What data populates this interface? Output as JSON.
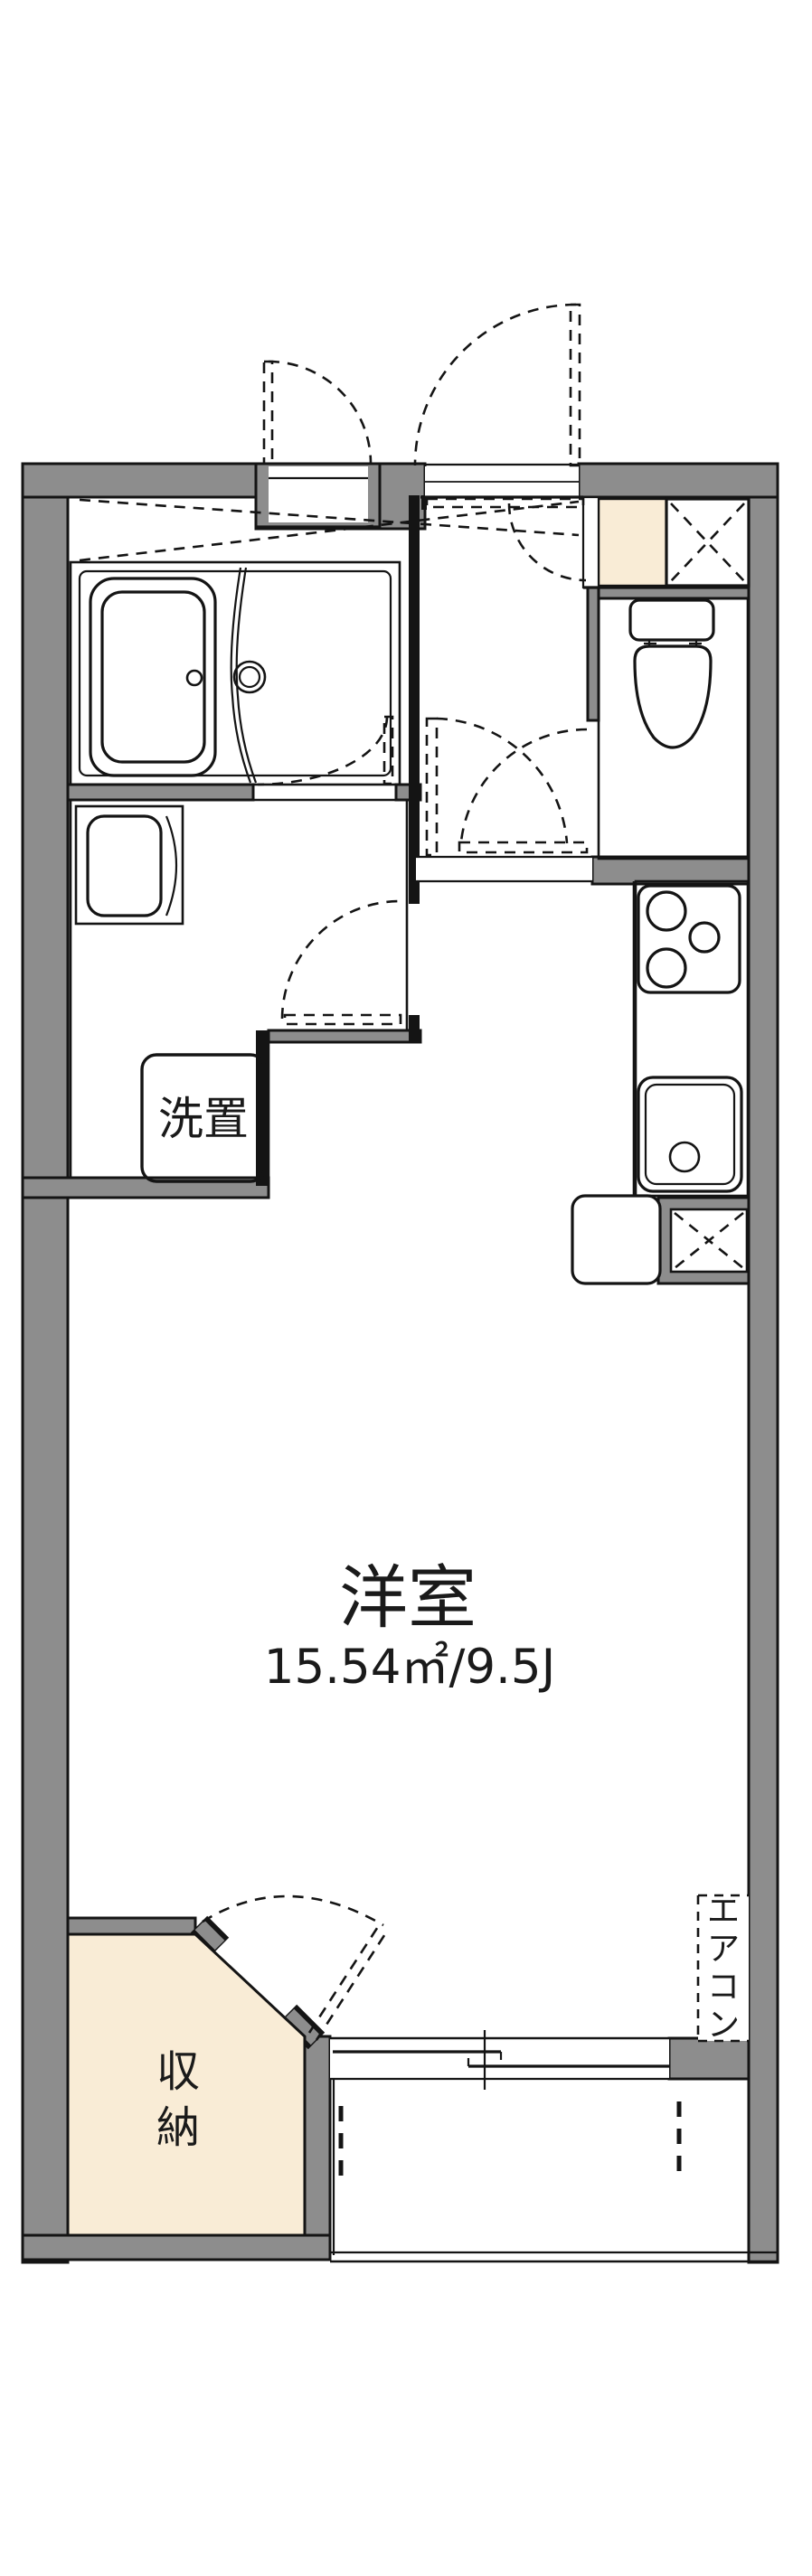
{
  "plan": {
    "main_room": {
      "label": "洋室",
      "area": "15.54㎡/9.5J"
    },
    "laundry": {
      "label": "洗置"
    },
    "storage": {
      "chars": [
        "収",
        "納"
      ]
    },
    "aircon": {
      "chars": [
        "エ",
        "ア",
        "コ",
        "ン"
      ]
    }
  },
  "colors": {
    "wall": "#8d8d8d",
    "water": "#dbe7f9",
    "storage_fill": "#f9ecd6",
    "line": "#141414",
    "background": "#ffffff"
  }
}
